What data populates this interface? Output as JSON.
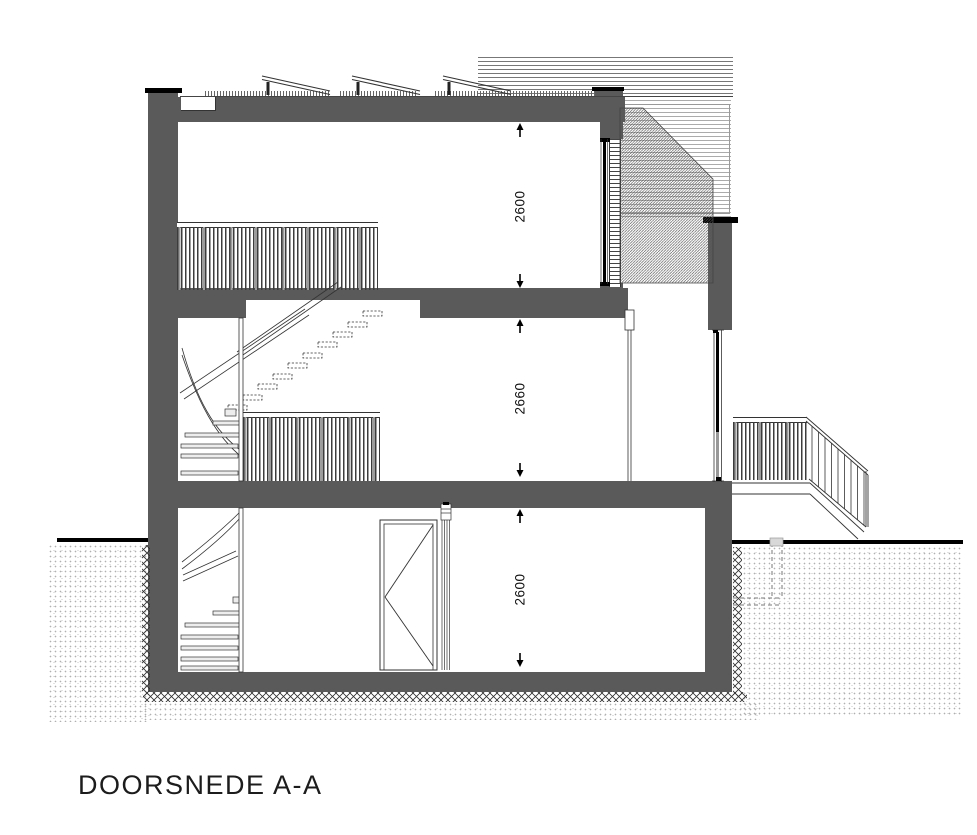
{
  "drawing": {
    "title": "DOORSNEDE A-A",
    "dimensions": {
      "top_floor": "2600",
      "middle_floor": "2660",
      "ground_floor": "2600"
    },
    "colors": {
      "wall": "#5a5a5a",
      "line": "#333333",
      "black": "#000000",
      "paper": "#ffffff"
    }
  }
}
